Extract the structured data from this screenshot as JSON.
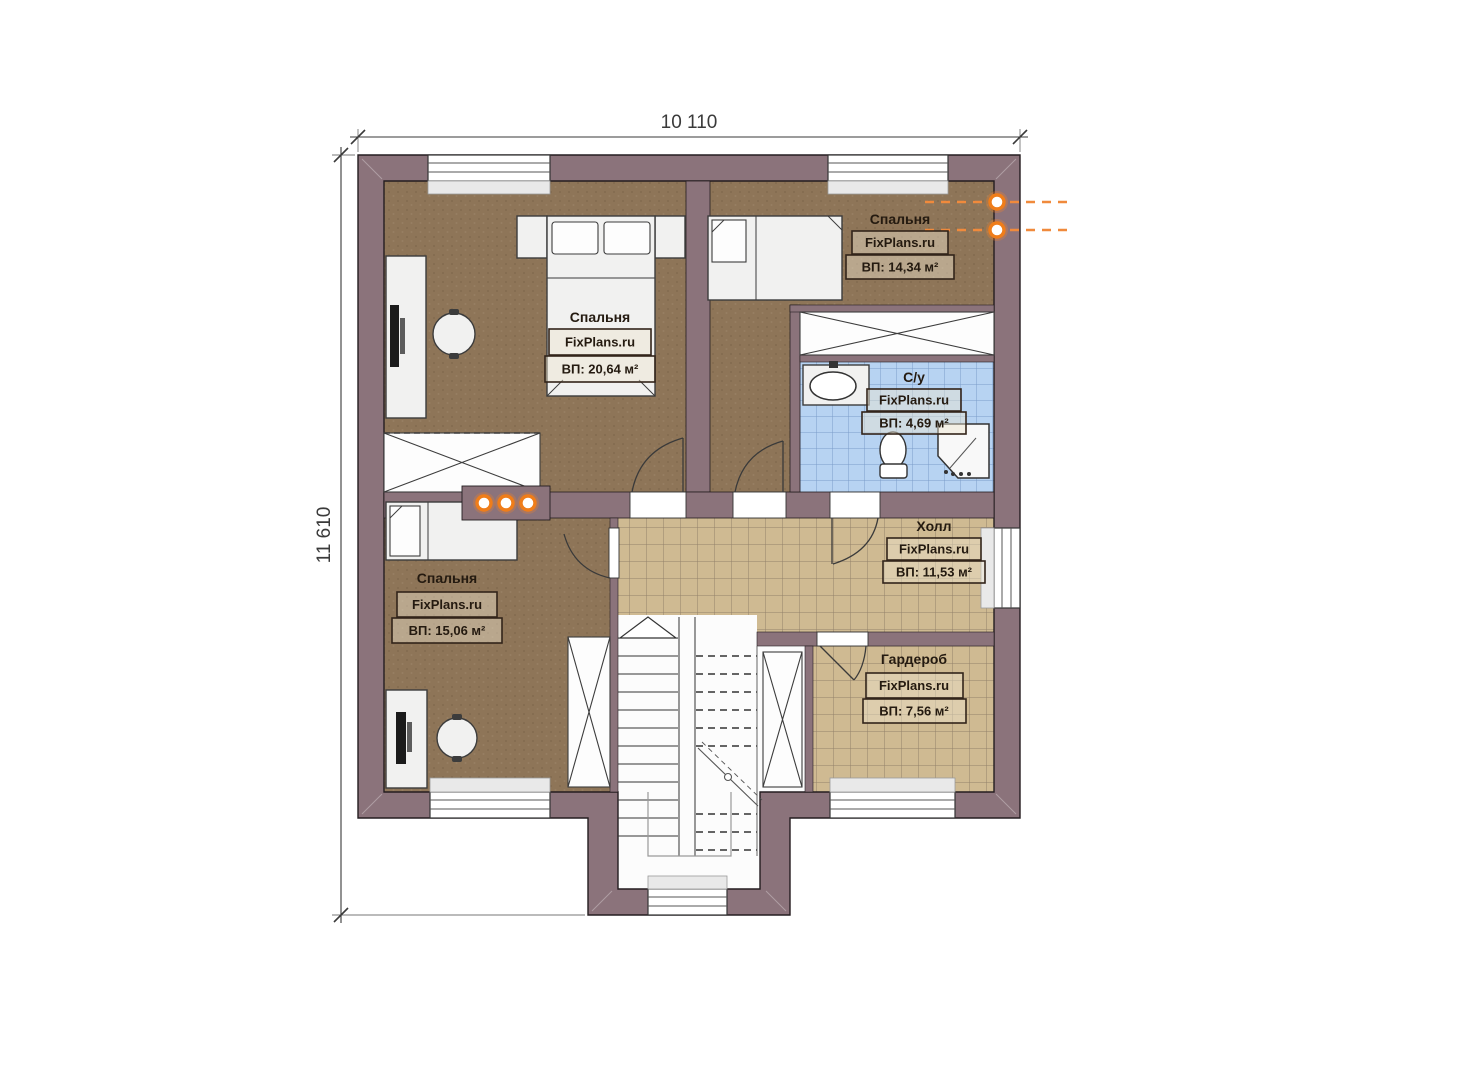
{
  "plan": {
    "brand": "FixPlans.ru",
    "dimensions": {
      "top": "10 110",
      "left": "11 610"
    },
    "rooms": {
      "bedroom1": {
        "name": "Спальня",
        "brand": "FixPlans.ru",
        "area": "ВП: 20,64 м²"
      },
      "bedroom2": {
        "name": "Спальня",
        "brand": "FixPlans.ru",
        "area": "ВП: 14,34 м²"
      },
      "bathroom": {
        "name": "С/у",
        "brand": "FixPlans.ru",
        "area": "ВП: 4,69 м²"
      },
      "hall": {
        "name": "Холл",
        "brand": "FixPlans.ru",
        "area": "ВП: 11,53 м²"
      },
      "bedroom3": {
        "name": "Спальня",
        "brand": "FixPlans.ru",
        "area": "ВП: 15,06 м²"
      },
      "wardrobe": {
        "name": "Гардероб",
        "brand": "FixPlans.ru",
        "area": "ВП: 7,56 м²"
      }
    },
    "colors": {
      "wall": "#8b737b",
      "bedroom_floor": "#8e7558",
      "tile_floor": "#cfba92",
      "bath_tile": "#b7d3f2",
      "accent_orange": "#ef7d1a"
    }
  }
}
